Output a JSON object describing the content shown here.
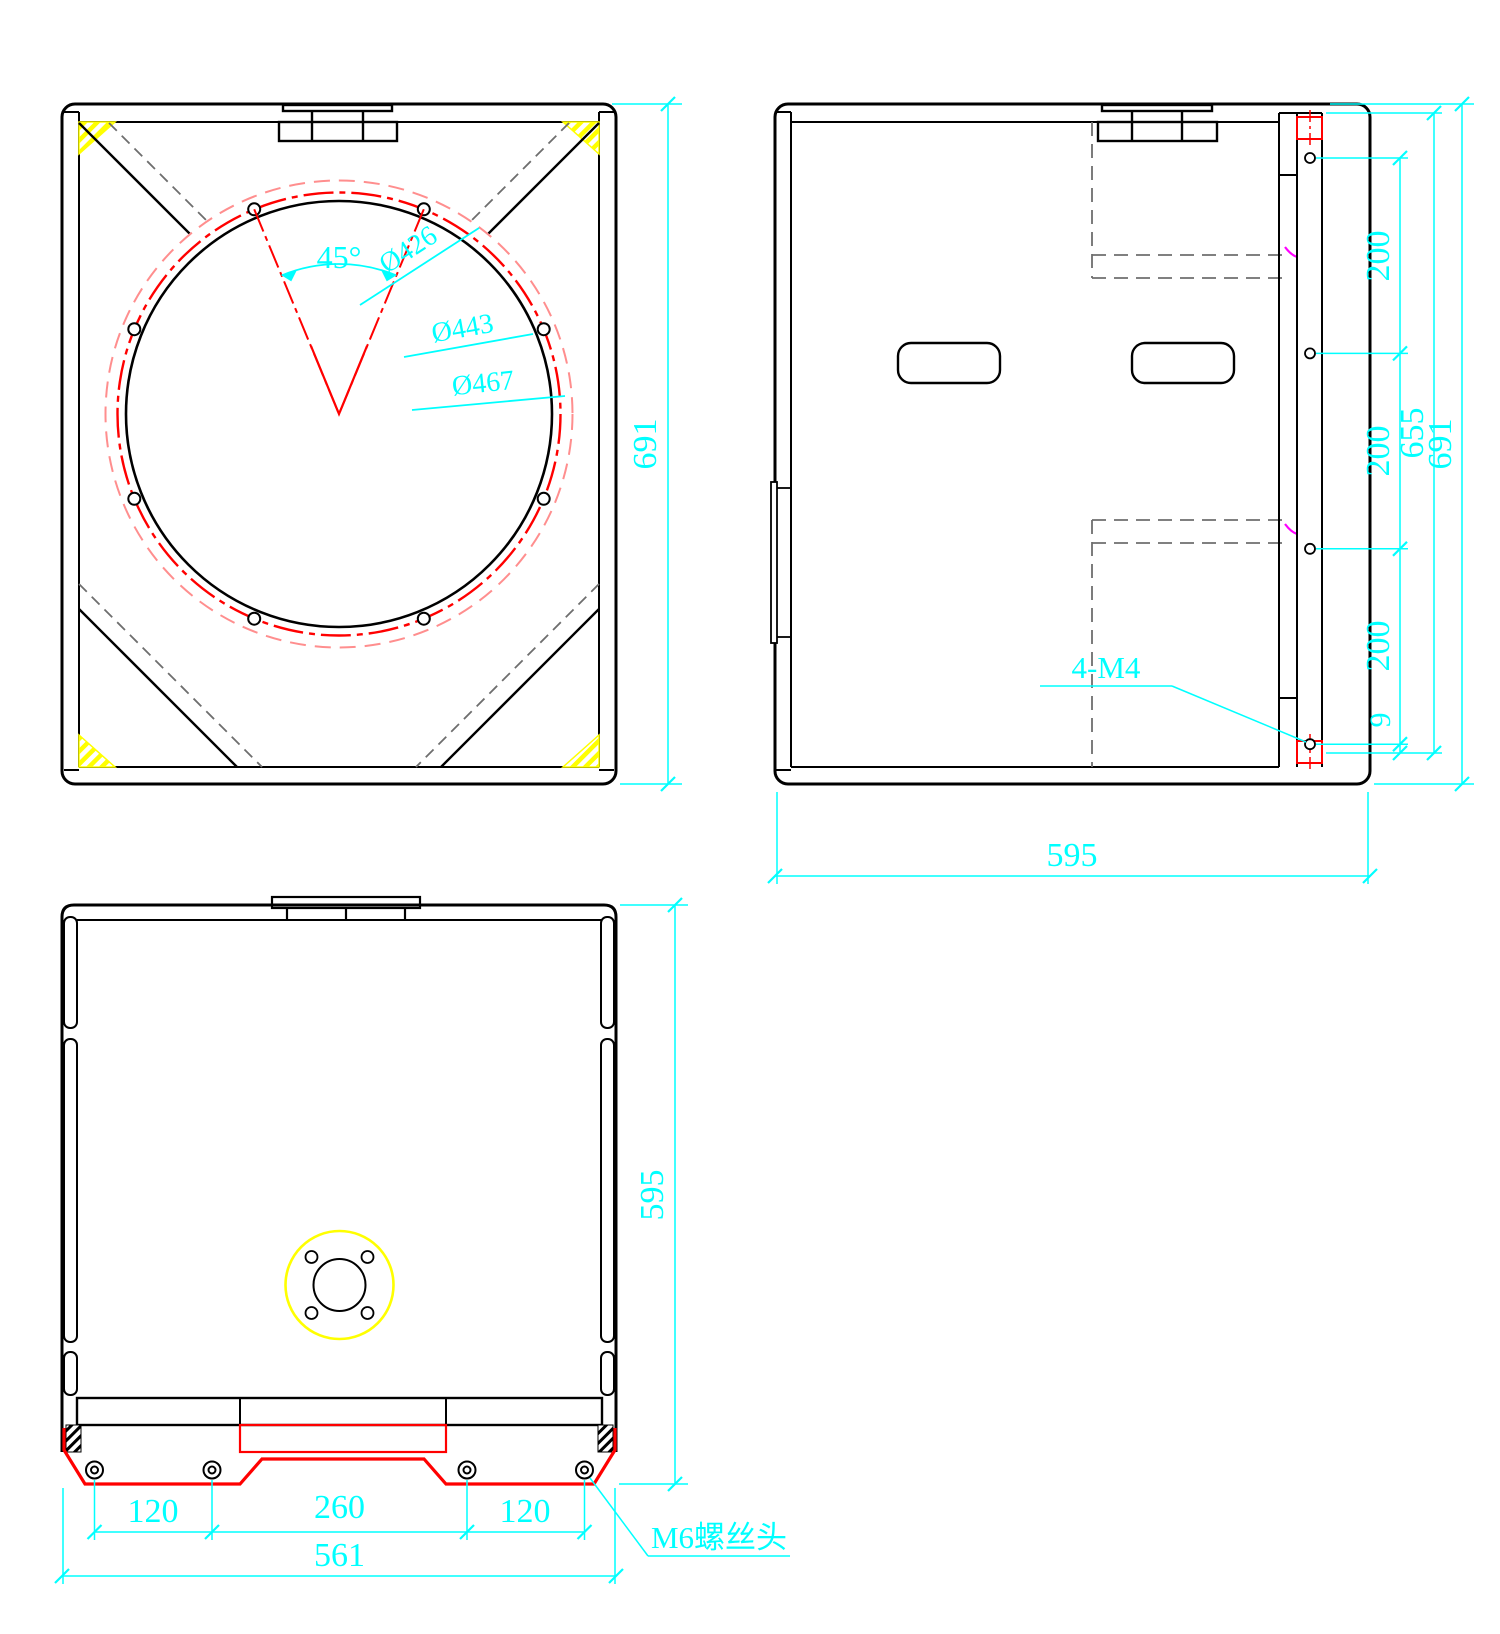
{
  "front_view": {
    "angle_label": "45°",
    "diameter_labels": [
      "Ø426",
      "Ø443",
      "Ø467"
    ],
    "height_dim": "691"
  },
  "side_view": {
    "hole_pitch_dims": [
      "200",
      "200",
      "200"
    ],
    "hole_edge_dim": "9",
    "panel_height_dim": "655",
    "height_dim": "691",
    "depth_dim": "595",
    "thread_label": "4-M4"
  },
  "bottom_view": {
    "depth_dim": "595",
    "screw_pitch_dims": [
      "120",
      "260",
      "120"
    ],
    "width_dim": "561",
    "screw_head_label": "M6螺丝头"
  },
  "colors": {
    "dimension_cyan": "#00ffff",
    "outline_black": "#000000",
    "hidden_gray": "#6e6e6e",
    "highlight_red": "#ff0000",
    "pink_red": "#ff8e8e",
    "magenta": "#ff00ff",
    "hatch_yellow": "#ffff00"
  }
}
